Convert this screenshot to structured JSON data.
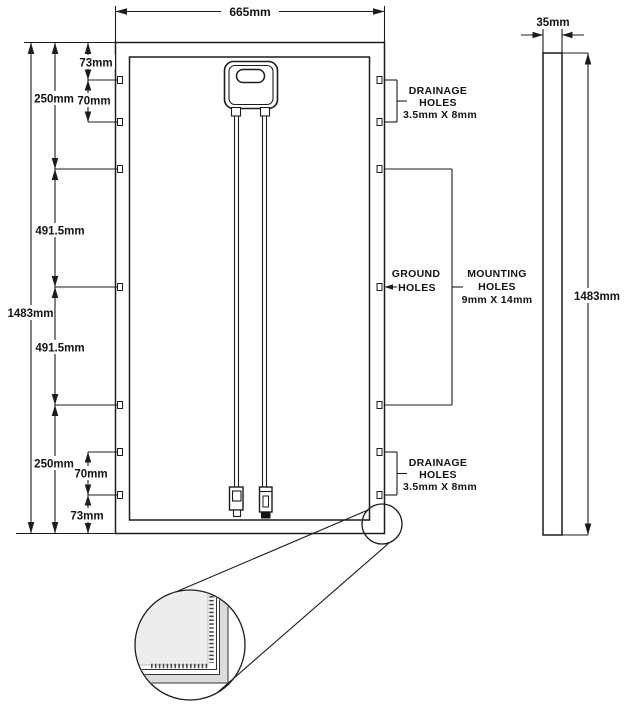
{
  "front_view": {
    "width_dim": "665mm",
    "height_dim": "1483mm",
    "top_edge_to_drainage": "73mm",
    "top_edge_to_mounting": "250mm",
    "drainage_spacing_top": "70mm",
    "mounting_spacing_upper": "491.5mm",
    "mounting_spacing_lower": "491.5mm",
    "bottom_edge_to_mounting": "250mm",
    "drainage_spacing_bottom": "70mm",
    "bottom_edge_to_drainage": "73mm"
  },
  "side_view": {
    "thickness_dim": "35mm",
    "height_dim": "1483mm"
  },
  "callouts": {
    "drainage_top": {
      "line1": "DRAINAGE",
      "line2": "HOLES",
      "line3": "3.5mm X 8mm"
    },
    "ground": {
      "line1": "GROUND",
      "line2": "HOLES"
    },
    "mounting": {
      "line1": "MOUNTING",
      "line2": "HOLES",
      "line3": "9mm X 14mm"
    },
    "drainage_bottom": {
      "line1": "DRAINAGE",
      "line2": "HOLES",
      "line3": "3.5mm X 8mm"
    }
  },
  "colors": {
    "line": "#1c1c1c",
    "background": "#ffffff",
    "glass_fill": "#ededed",
    "frame_fill": "#dcdcdc"
  }
}
